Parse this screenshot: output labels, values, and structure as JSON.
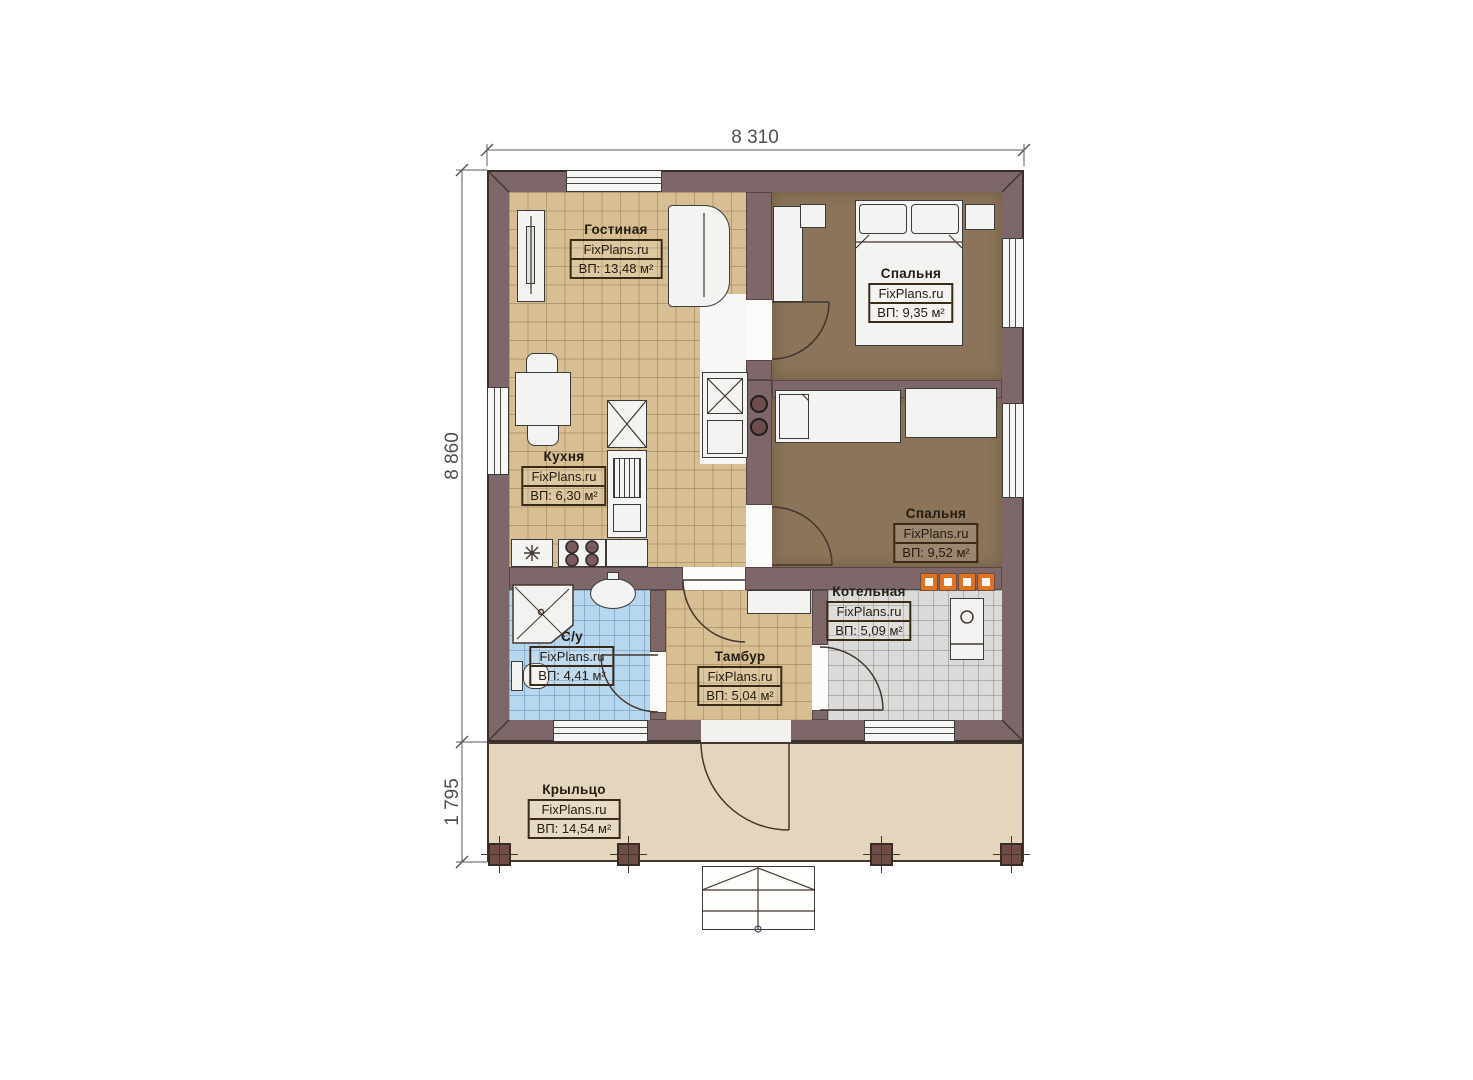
{
  "title": "План одноэтажного дома FixPlans.ru",
  "dimensions": {
    "width_top": "8 310",
    "height_left": "8 860",
    "porch_height_left": "1 795"
  },
  "rooms": [
    {
      "id": "living",
      "name": "Гостиная",
      "brand": "FixPlans.ru",
      "area": "ВП: 13,48 м²"
    },
    {
      "id": "bedroom1",
      "name": "Спальня",
      "brand": "FixPlans.ru",
      "area": "ВП: 9,35 м²"
    },
    {
      "id": "kitchen",
      "name": "Кухня",
      "brand": "FixPlans.ru",
      "area": "ВП: 6,30 м²"
    },
    {
      "id": "bedroom2",
      "name": "Спальня",
      "brand": "FixPlans.ru",
      "area": "ВП: 9,52 м²"
    },
    {
      "id": "boiler",
      "name": "Котельная",
      "brand": "FixPlans.ru",
      "area": "ВП: 5,09 м²"
    },
    {
      "id": "bathroom",
      "name": "С/у",
      "brand": "FixPlans.ru",
      "area": "ВП: 4,41 м²"
    },
    {
      "id": "tambour",
      "name": "Тамбур",
      "brand": "FixPlans.ru",
      "area": "ВП: 5,04 м²"
    },
    {
      "id": "porch",
      "name": "Крыльцо",
      "brand": "FixPlans.ru",
      "area": "ВП: 14,54 м²"
    }
  ],
  "fixtures": [
    "tv-unit",
    "sofa",
    "dining-table",
    "chair",
    "fridge",
    "kitchen-cabinet",
    "stove-burners",
    "corner-shower",
    "washbasin",
    "toilet",
    "double-bed",
    "single-bed",
    "wardrobe",
    "nightstand",
    "boiler-unit",
    "hall-cabinet",
    "masonry-stove",
    "chimney-blocks",
    "porch-posts",
    "entry-stairs"
  ],
  "colors": {
    "wall": "#7d6769",
    "floor_tile": "#d7bf93",
    "bedroom_floor": "#8b7459",
    "bathroom_tile": "#b7d7ee",
    "boiler_tile": "#dadad8",
    "porch": "#e4d6bd",
    "accent_orange": "#e2711d",
    "furniture": "#f3f3f1",
    "post": "#6f4c44",
    "label_text": "#241c12",
    "dim_text": "#4f4f4f"
  }
}
